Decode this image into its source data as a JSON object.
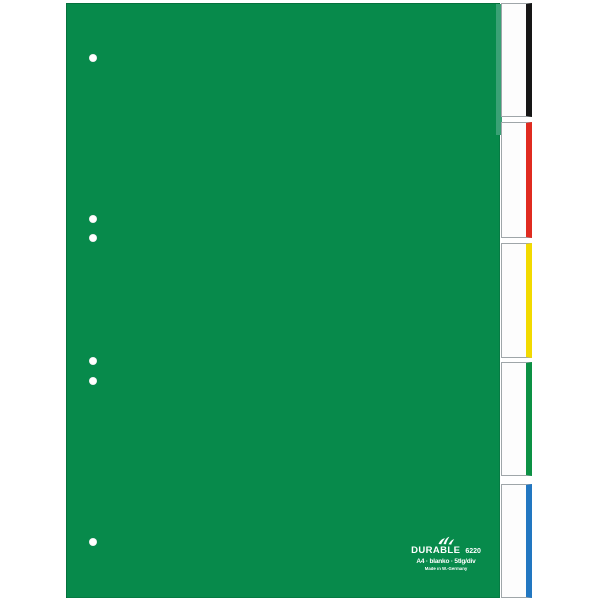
{
  "product": {
    "brand": "DURABLE",
    "model_number": "6220",
    "spec_line": "A4 · blanko · 5tlg/div",
    "origin_line": "Made in W.-Germany"
  },
  "sheet": {
    "color": "#078a4b",
    "edge_highlight_color": "#3aa175",
    "punch_hole_count": 6
  },
  "tabs": [
    {
      "name": "tab-1-black",
      "color": "#161616"
    },
    {
      "name": "tab-2-red",
      "color": "#e02b20"
    },
    {
      "name": "tab-3-yellow",
      "color": "#f2da00"
    },
    {
      "name": "tab-4-green",
      "color": "#0c9144"
    },
    {
      "name": "tab-5-blue",
      "color": "#2277c1"
    }
  ],
  "background_color": "#ffffff"
}
